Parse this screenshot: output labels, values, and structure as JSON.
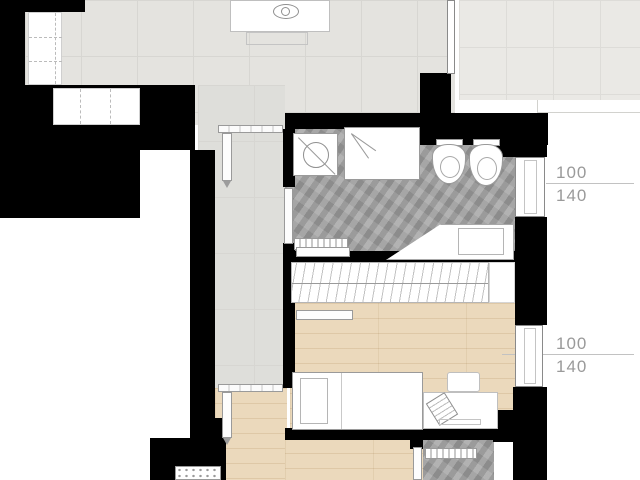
{
  "plan": {
    "type": "apartment-floor-plan",
    "annotations": [
      {
        "id": "upper-window-dimension",
        "top_value": "100",
        "bottom_value": "140"
      },
      {
        "id": "lower-window-dimension",
        "top_value": "100",
        "bottom_value": "140"
      }
    ],
    "colors": {
      "wall": "#000000",
      "tile_floor": "#e4e3df",
      "terrace_floor": "#eae9e5",
      "bathroom_floor": "#9f9f9f",
      "wood_floor": "#ebd9bc",
      "fixture_outline": "#9a9a9a",
      "annotation_text": "#9a9a9a",
      "background": "#ffffff"
    },
    "rooms": [
      "living-kitchen",
      "terrace",
      "corridor",
      "bathroom",
      "bedroom",
      "second-room",
      "second-bathroom"
    ],
    "fixtures": [
      "kitchen-island",
      "cooktop",
      "tall-closet",
      "built-in-closet",
      "shower",
      "washbasin-vanity",
      "bidet",
      "toilet",
      "bathtub",
      "towel-radiator",
      "wardrobe-rail",
      "single-bed",
      "pillow",
      "desk",
      "chair",
      "laptop",
      "radiator",
      "interior-doors",
      "windows"
    ]
  }
}
